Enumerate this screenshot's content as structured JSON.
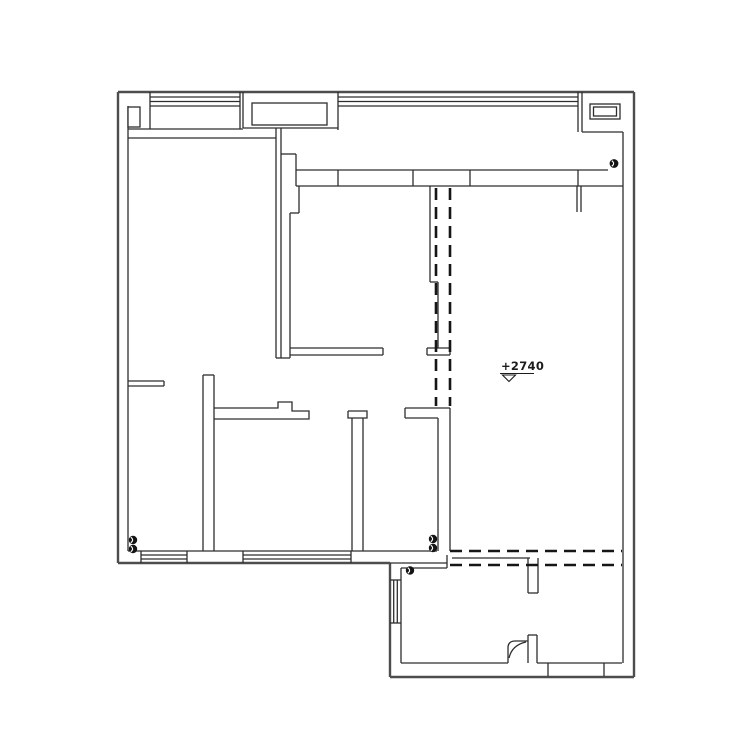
{
  "canvas": {
    "width": 750,
    "height": 751,
    "background": "#ffffff",
    "thin_color": "#2e2e2e",
    "thick_color": "#4d4d4d",
    "dash_color": "#161616"
  },
  "elevation_marker": {
    "label": "+2740",
    "text_x": 501,
    "text_y": 370,
    "underline_path": "M500,373.5 H534",
    "triangle_path": "M502.5,375 L515.5,375 L509,381.5 Z"
  },
  "layers": {
    "thick_walls": {
      "stroke_width": 2.4,
      "paths": [
        "M118,92 H634",
        "M118,92 V563",
        "M634,92 V677",
        "M118,563 H390",
        "M390,563 V677",
        "M390,677 H634"
      ]
    },
    "thin_walls": {
      "stroke_width": 1.3,
      "paths": [
        "M150,97 H240",
        "M150,101.5 H240",
        "M150,106 H240",
        "M150,92 V129",
        "M240,92 V129",
        "M128,129 H243",
        "M243,92 V128",
        "M243,128 H338",
        "M338,92 V130",
        "M338,97 H578",
        "M338,101.5 H578",
        "M338,106 H578",
        "M578,92 V132",
        "M582,92 V132",
        "M582,132 H623",
        "M623,132 V663",
        "M276,128 V358",
        "M281,128 V358",
        "M276,358 H290",
        "M281,154 H296",
        "M296,154 V186",
        "M296,170 H608",
        "M296,186 H623",
        "M338,170 V186",
        "M413,170 V186",
        "M470,170 V186",
        "M578,170 V186",
        "M577,186 V212",
        "M581,186 V212",
        "M299,186 V213",
        "M290,213 H299",
        "M290,213 V358",
        "M290,348 H383",
        "M290,355 H383",
        "M383,348 V355",
        "M430,186 V282",
        "M430,282 H438",
        "M438,282 V348",
        "M427,348 H450",
        "M427,355 H450",
        "M427,348 V355",
        "M450,348 V355",
        "M128,106 V551",
        "M128,138 H276",
        "M128,381 H164",
        "M128,386 H164",
        "M164,381 V386",
        "M203,375 V551",
        "M214,375 V551",
        "M203,375 H214",
        "M214,408 H278 V402 H292 V411 H309 V419 H214",
        "M348,411 H367 V418 H348 V411",
        "M352,418 V551",
        "M363,418 V551",
        "M405,408 H450",
        "M405,418 H438",
        "M405,408 V418",
        "M438,418 V551",
        "M450,408 V551",
        "M128,551 H437",
        "M141,555 H187",
        "M141,559 H187",
        "M141,551 V563",
        "M187,551 V563",
        "M243,555 H351",
        "M243,559 H351",
        "M243,551 V563",
        "M351,551 V563",
        "M390,563 H447",
        "M401,568 H447",
        "M447,555 V568",
        "M452,558 H530",
        "M528,558 V593",
        "M538,558 V593",
        "M528,593 H538",
        "M401,568 V663",
        "M390,580 H401",
        "M390,623 H401",
        "M393.7,580 V623",
        "M397.3,580 V623",
        "M401,663 H508",
        "M537,663 H622",
        "M548,663 V676",
        "M604,663 V676",
        "M528,635 V663",
        "M537,635 V663",
        "M528,635 H537",
        "M508,663 V648 Q508,641 515,641 H528",
        "M509,658 Q512,645 526,642"
      ]
    },
    "dashed_lines": {
      "stroke_width": 2.6,
      "dash": "12 7",
      "paths": [
        "M436,188 V406",
        "M450,188 V406",
        "M450,551 H622",
        "M450,565 H622"
      ]
    },
    "column_rects": [
      {
        "x": 128,
        "y": 107,
        "w": 12,
        "h": 20
      },
      {
        "x": 252,
        "y": 103,
        "w": 75,
        "h": 22
      },
      {
        "x": 590,
        "y": 104,
        "w": 30,
        "h": 15
      },
      {
        "x": 593.5,
        "y": 107,
        "w": 23,
        "h": 9
      }
    ],
    "circle_markers": [
      {
        "cx": 614,
        "cy": 163.5,
        "r": 4.4
      },
      {
        "cx": 133,
        "cy": 540,
        "r": 4.2
      },
      {
        "cx": 133,
        "cy": 549,
        "r": 4.2
      },
      {
        "cx": 433,
        "cy": 539,
        "r": 4.2
      },
      {
        "cx": 433,
        "cy": 548,
        "r": 4.2
      },
      {
        "cx": 410,
        "cy": 570.5,
        "r": 4.2
      }
    ]
  }
}
